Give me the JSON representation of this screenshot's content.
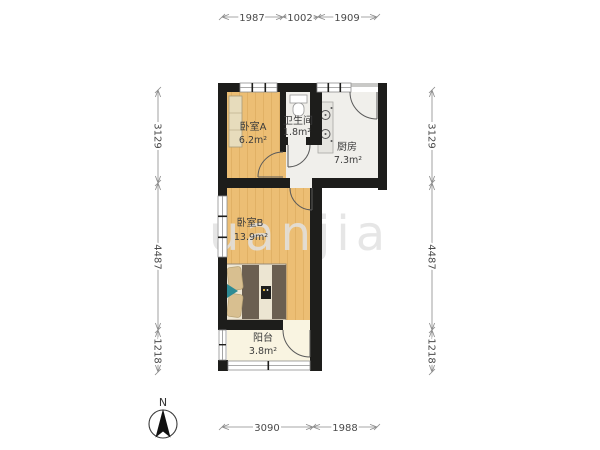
{
  "floorplan": {
    "rooms": [
      {
        "name": "卧室A",
        "area": "6.2m²"
      },
      {
        "name": "卫生间",
        "area": "1.8m²"
      },
      {
        "name": "厨房",
        "area": "7.3m²"
      },
      {
        "name": "卧室B",
        "area": "13.9m²"
      },
      {
        "name": "阳台",
        "area": "3.8m²"
      }
    ],
    "dimensions_mm": {
      "top": [
        "1987",
        "1002",
        "1909"
      ],
      "left": [
        "3129",
        "4487",
        "1218"
      ],
      "right": [
        "3129",
        "4487",
        "1218"
      ],
      "bottom": [
        "3090",
        "1988"
      ]
    },
    "compass_label": "N",
    "watermark": "uanjia",
    "colors": {
      "wall": "#1d1d1b",
      "wood_floor": "#ecbe74",
      "wood_plank_line": "#d9a558",
      "tile_floor": "#f0efeb",
      "balcony_floor": "#f9f4e1",
      "wardrobe_fill": "#e7dcbc",
      "duvet_fill": "#6b5f51",
      "pillow_fill": "#d8bf90",
      "accent_pillow": "#2e8b94",
      "watermark_color": "#e2e2e2",
      "dim_text": "#4a4a4a"
    }
  }
}
